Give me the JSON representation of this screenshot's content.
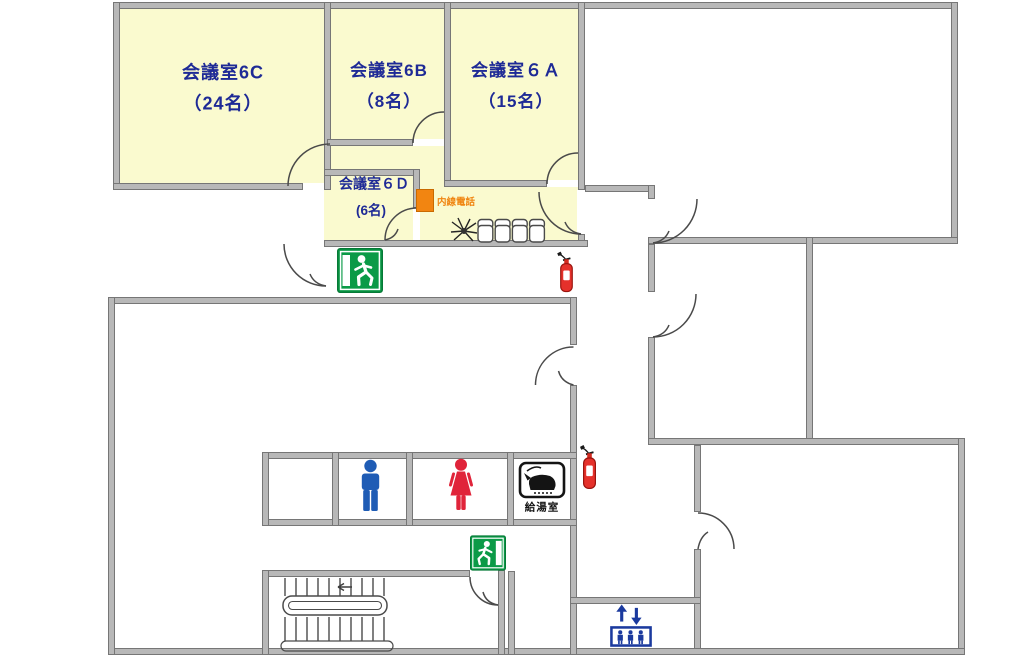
{
  "plan": {
    "kind": "office-floor-plan",
    "background": "#ffffff"
  },
  "colors": {
    "room_fill_yellow": "#fafacf",
    "wall_gray": "#b8b8b8",
    "wall_edge": "#767676",
    "room_label_navy": "#1e2a96",
    "intercom_orange": "#f28511",
    "exit_sign_green": "#0b9a47",
    "fire_extinguisher_red": "#e5312b",
    "men_restroom_blue": "#1f5cb5",
    "women_restroom_red": "#e0243a",
    "elevator_navy": "#1b3a9e",
    "kitchenette_black": "#141414"
  },
  "rooms": [
    {
      "name": "会議室6C",
      "capacity": "（24名）"
    },
    {
      "name": "会議室6B",
      "capacity": "（8名）"
    },
    {
      "name": "会議室６Ａ",
      "capacity": "（15名）"
    },
    {
      "name": "会議室６Ｄ",
      "capacity": "(6名)"
    }
  ],
  "labels": {
    "intercom": "内線電話",
    "kitchenette": "給湯室"
  },
  "icons": {
    "exit_sign": "running-man-emergency-exit",
    "fire_extinguisher": "fire-extinguisher",
    "men_restroom": "man-pictogram",
    "women_restroom": "woman-pictogram",
    "elevator": "elevator-up-down-arrows-with-people",
    "kitchenette_sign": "kettle-pictogram",
    "plant": "potted-plant-top-view",
    "waiting_chairs": "row-of-4-chairs",
    "stairs": "staircase-with-center-handrail"
  }
}
